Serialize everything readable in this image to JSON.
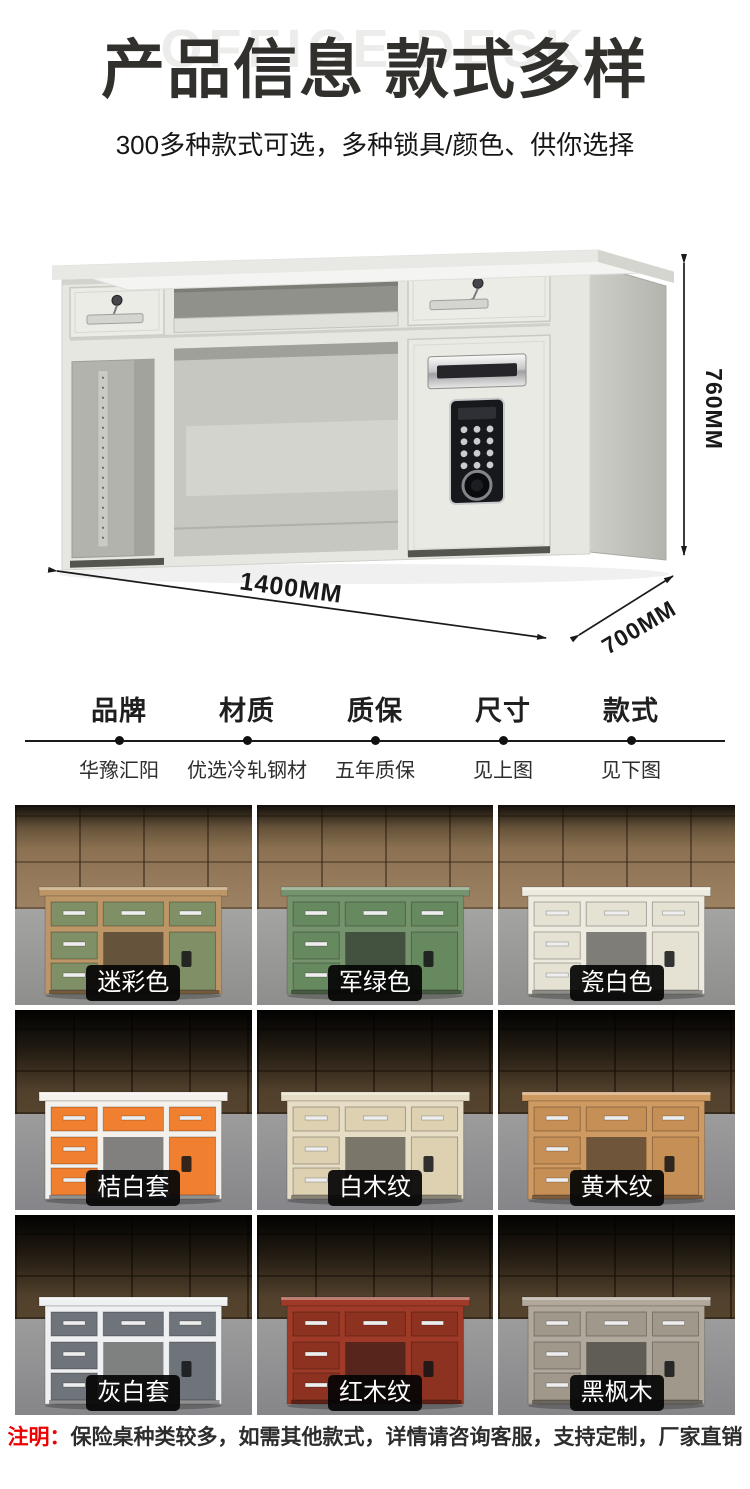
{
  "header": {
    "watermark": "OFFICE DESK",
    "title": "产品信息 款式多样",
    "subtitle": "300多种款式可选，多种锁具/颜色、供你选择"
  },
  "product_figure": {
    "height_label": "760MM",
    "width_label": "1400MM",
    "depth_label": "700MM"
  },
  "specs": {
    "columns": [
      {
        "label": "品牌",
        "value": "华豫汇阳"
      },
      {
        "label": "材质",
        "value": "优选冷轧钢材"
      },
      {
        "label": "质保",
        "value": "五年质保"
      },
      {
        "label": "尺寸",
        "value": "见上图"
      },
      {
        "label": "款式",
        "value": "见下图"
      }
    ]
  },
  "grid": {
    "items": [
      {
        "label": "迷彩色",
        "body_color": "#bd9668",
        "drawer_color": "#7f9066"
      },
      {
        "label": "军绿色",
        "body_color": "#75946d",
        "drawer_color": "#67895f"
      },
      {
        "label": "瓷白色",
        "body_color": "#edeadf",
        "drawer_color": "#e5e2d4"
      },
      {
        "label": "桔白套",
        "body_color": "#f4f1ec",
        "drawer_color": "#f08030"
      },
      {
        "label": "白木纹",
        "body_color": "#e7ddc4",
        "drawer_color": "#ddd1b2"
      },
      {
        "label": "黄木纹",
        "body_color": "#cf9a62",
        "drawer_color": "#c68f56"
      },
      {
        "label": "灰白套",
        "body_color": "#eef0f1",
        "drawer_color": "#6f747b"
      },
      {
        "label": "红木纹",
        "body_color": "#9e3a27",
        "drawer_color": "#8d3220"
      },
      {
        "label": "黑枫木",
        "body_color": "#b1a89c",
        "drawer_color": "#a1988c"
      }
    ]
  },
  "note": {
    "label": "注明：",
    "text": "保险桌种类较多，如需其他款式，详情请咨询客服，支持定制，厂家直销"
  },
  "colors": {
    "note_label": "#ee0000",
    "heading": "#32302c",
    "chip_background": "#050505",
    "chip_text": "#ffffff"
  }
}
